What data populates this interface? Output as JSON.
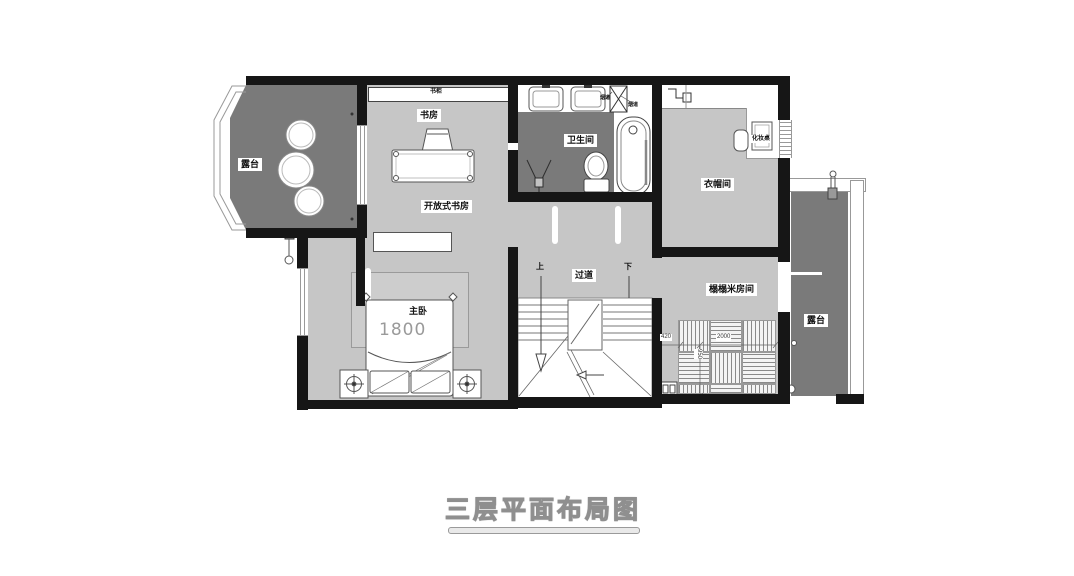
{
  "title": "三层平面布局图",
  "labels": {
    "terrace_left": "露台",
    "terrace_right": "露台",
    "bookcase": "书柜",
    "study": "书房",
    "open_study": "开放式书房",
    "bathroom": "卫生间",
    "duct_a": "烟道",
    "duct_b": "烟道",
    "cloakroom": "衣帽间",
    "makeup_table": "化妆桌",
    "master_bedroom": "主卧",
    "bed_width": "1800",
    "corridor": "过道",
    "stair_up": "上",
    "stair_down": "下",
    "tatami_room": "榻榻米房间"
  },
  "dimensions": {
    "gap": "420",
    "tatami_width": "2000",
    "tatami_depth": "950"
  },
  "colors": {
    "floor_light": "#c6c6c6",
    "floor_dark": "#7a7a7a",
    "wall": "#161616",
    "rug": "#cdcdcd"
  }
}
